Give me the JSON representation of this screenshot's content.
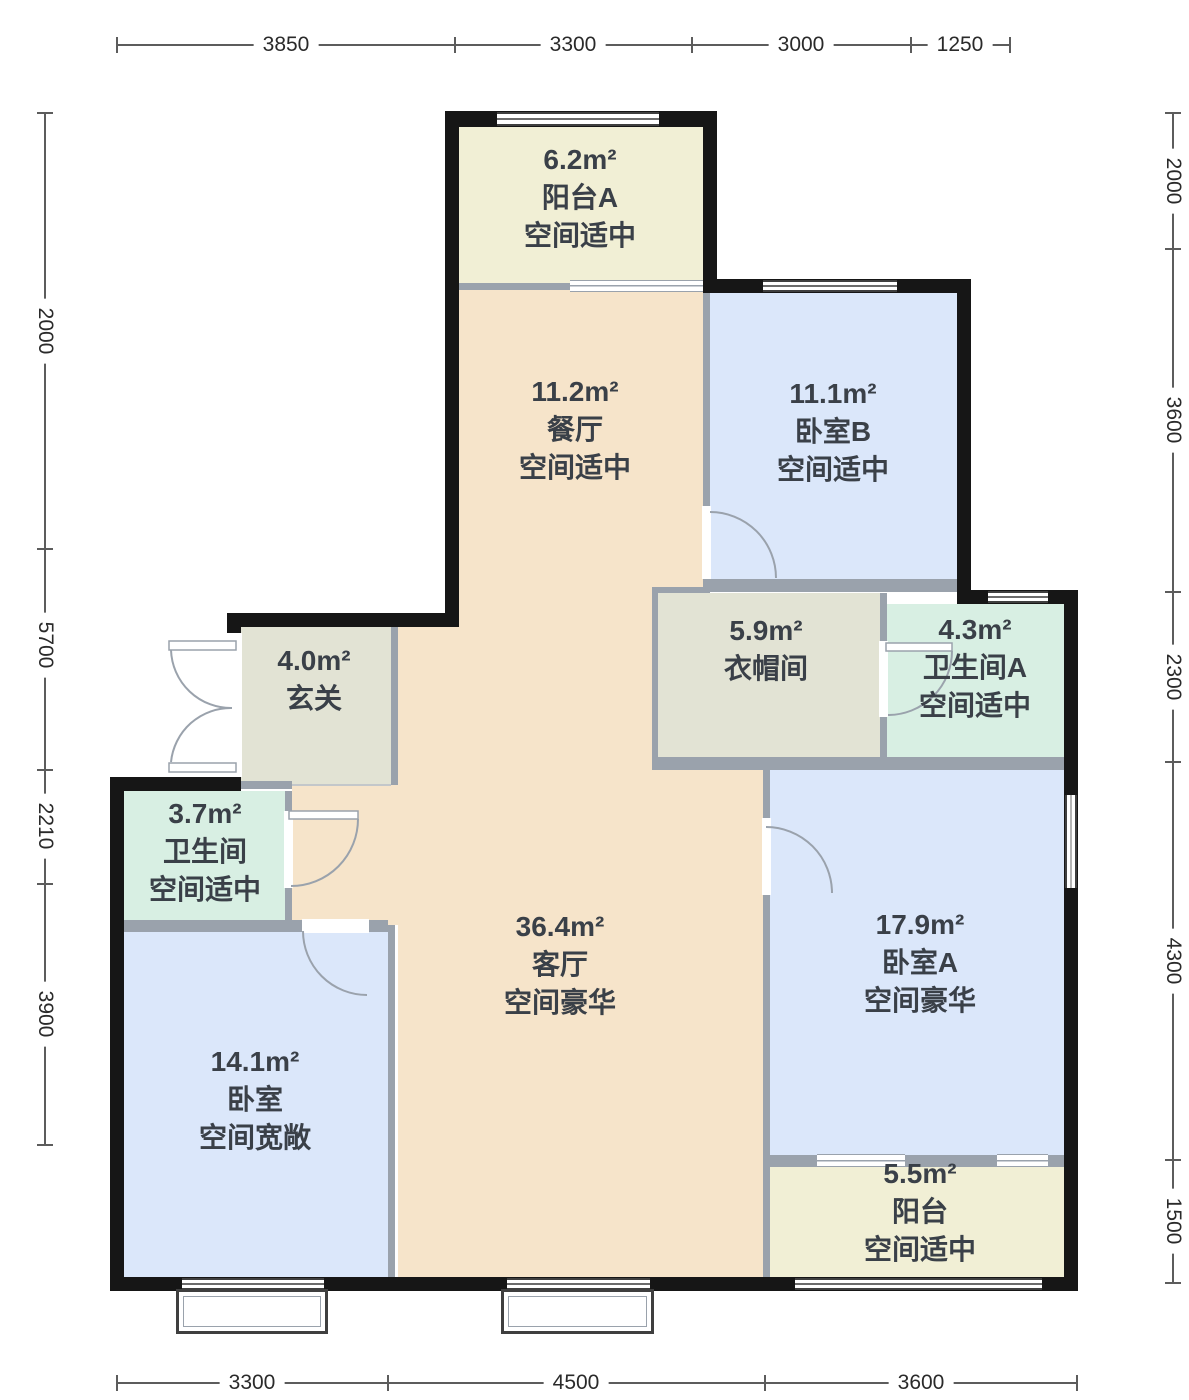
{
  "type": "residential-floor-plan",
  "palette": {
    "exterior_wall": "#161616",
    "partition_wall": "#9aa2ac",
    "living_dining": "#f6e4ca",
    "bedroom": "#dbe7fa",
    "balcony": "#f1efd5",
    "service": "#e2e3d4",
    "bathroom": "#d8efe3",
    "background": "#ffffff"
  },
  "rooms": {
    "balcony_a": {
      "area": "6.2m²",
      "name": "阳台A",
      "note": "空间适中"
    },
    "dining": {
      "area": "11.2m²",
      "name": "餐厅",
      "note": "空间适中"
    },
    "bedroom_b": {
      "area": "11.1m²",
      "name": "卧室B",
      "note": "空间适中"
    },
    "closet": {
      "area": "5.9m²",
      "name": "衣帽间"
    },
    "bath_a": {
      "area": "4.3m²",
      "name": "卫生间A",
      "note": "空间适中"
    },
    "entry": {
      "area": "4.0m²",
      "name": "玄关"
    },
    "bath": {
      "area": "3.7m²",
      "name": "卫生间",
      "note": "空间适中"
    },
    "living": {
      "area": "36.4m²",
      "name": "客厅",
      "note": "空间豪华"
    },
    "bedroom_a": {
      "area": "17.9m²",
      "name": "卧室A",
      "note": "空间豪华"
    },
    "bedroom": {
      "area": "14.1m²",
      "name": "卧室",
      "note": "空间宽敞"
    },
    "balcony": {
      "area": "5.5m²",
      "name": "阳台",
      "note": "空间适中"
    }
  },
  "dimensions": {
    "top": [
      "3850",
      "3300",
      "3000",
      "1250"
    ],
    "bottom": [
      "3300",
      "4500",
      "3600"
    ],
    "left": [
      "2000",
      "5700",
      "2210",
      "3900"
    ],
    "right": [
      "2000",
      "3600",
      "2300",
      "4300",
      "1500"
    ]
  }
}
